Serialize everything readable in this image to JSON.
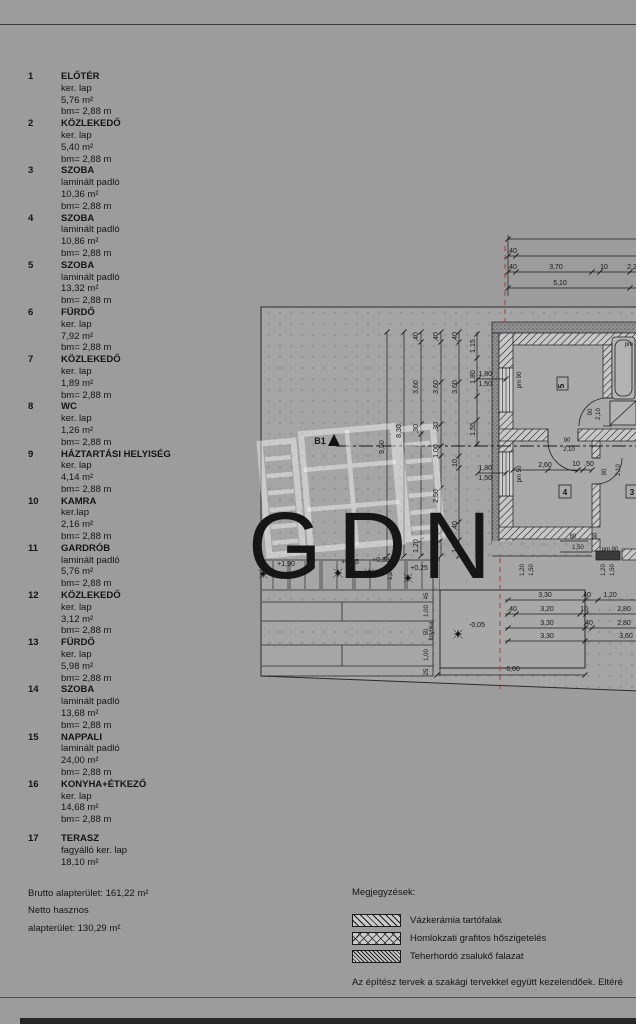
{
  "page": {
    "bottom_note": "Az építész tervek a szakági tervekkel együtt kezelendőek. Eltéré",
    "watermark": "GDN"
  },
  "schedule": {
    "rooms": [
      {
        "num": "1",
        "name": "ELŐTÉR",
        "floor": "ker. lap",
        "area": "5,76 m²",
        "height": "bm= 2,88 m"
      },
      {
        "num": "2",
        "name": "KÖZLEKEDŐ",
        "floor": "ker. lap",
        "area": "5,40 m²",
        "height": "bm= 2,88 m"
      },
      {
        "num": "3",
        "name": "SZOBA",
        "floor": "laminált padló",
        "area": "10,36 m²",
        "height": "bm= 2,88 m"
      },
      {
        "num": "4",
        "name": "SZOBA",
        "floor": "laminált padló",
        "area": "10,86 m²",
        "height": "bm= 2,88 m"
      },
      {
        "num": "5",
        "name": "SZOBA",
        "floor": "laminált padló",
        "area": "13,32 m²",
        "height": "bm= 2,88 m"
      },
      {
        "num": "6",
        "name": "FÜRDŐ",
        "floor": "ker. lap",
        "area": "7,92 m²",
        "height": "bm= 2,88 m"
      },
      {
        "num": "7",
        "name": "KÖZLEKEDŐ",
        "floor": "ker. lap",
        "area": "1,89 m²",
        "height": "bm= 2,88 m"
      },
      {
        "num": "8",
        "name": "WC",
        "floor": "ker. lap",
        "area": "1,26 m²",
        "height": "bm= 2,88 m"
      },
      {
        "num": "9",
        "name": "HÁZTARTÁSI HELYISÉG",
        "floor": "ker. lap",
        "area": "4,14 m²",
        "height": "bm= 2,88 m"
      },
      {
        "num": "10",
        "name": "KAMRA",
        "floor": "ker.lap",
        "area": "2,16 m²",
        "height": "bm= 2,88 m"
      },
      {
        "num": "11",
        "name": "GARDRÓB",
        "floor": "laminált padló",
        "area": "5,76 m²",
        "height": "bm= 2,88 m"
      },
      {
        "num": "12",
        "name": "KÖZLEKEDŐ",
        "floor": "ker. lap",
        "area": "3,12 m²",
        "height": "bm= 2,88 m"
      },
      {
        "num": "13",
        "name": "FÜRDŐ",
        "floor": "ker. lap",
        "area": "5,98 m²",
        "height": "bm= 2,88 m"
      },
      {
        "num": "14",
        "name": "SZOBA",
        "floor": "laminált padló",
        "area": "13,68 m²",
        "height": "bm= 2,88 m"
      },
      {
        "num": "15",
        "name": "NAPPALI",
        "floor": "laminált padló",
        "area": "24,00 m²",
        "height": "bm= 2,88 m"
      },
      {
        "num": "16",
        "name": "KONYHA+ÉTKEZŐ",
        "floor": "ker. lap",
        "area": "14,68 m²",
        "height": "bm= 2,88 m"
      }
    ],
    "room17": {
      "num": "17",
      "name": "TERASZ",
      "floor": "fagyálló ker. lap",
      "area": "18,10 m²",
      "height": ""
    },
    "totals": {
      "line1": "Brutto alapterület: 161,22 m²",
      "line2": "Netto hasznos",
      "line3": "alapterület: 130,29 m²"
    }
  },
  "notes": {
    "title": "Megjegyzések:",
    "legend": [
      {
        "label": "Vázkerámia tartófalak",
        "pattern": "diag"
      },
      {
        "label": "Homlokzati grafitos hőszigetelés",
        "pattern": "crossx"
      },
      {
        "label": "Teherhordó zsalukő falazat",
        "pattern": "dense"
      }
    ]
  },
  "plan": {
    "section_label": "B1",
    "texts": [
      {
        "t": ",40",
        "x": 512,
        "y": 253
      },
      {
        "t": ",40",
        "x": 512,
        "y": 269
      },
      {
        "t": "3,70",
        "x": 556,
        "y": 269
      },
      {
        "t": "10",
        "x": 604,
        "y": 269
      },
      {
        "t": "2,2",
        "x": 632,
        "y": 269
      },
      {
        "t": "5,10",
        "x": 560,
        "y": 285
      },
      {
        "t": "9,50",
        "x": 384,
        "y": 447,
        "r": -90
      },
      {
        "t": "8,30",
        "x": 401,
        "y": 431,
        "r": -90
      },
      {
        "t": ",40",
        "x": 418,
        "y": 337,
        "r": -90
      },
      {
        "t": "3,60",
        "x": 418,
        "y": 387,
        "r": -90
      },
      {
        "t": ",30",
        "x": 418,
        "y": 429,
        "r": -90
      },
      {
        "t": "1,20",
        "x": 418,
        "y": 546,
        "r": -90
      },
      {
        "t": ",40",
        "x": 438,
        "y": 337,
        "r": -90
      },
      {
        "t": "3,60",
        "x": 438,
        "y": 387,
        "r": -90
      },
      {
        "t": ",30",
        "x": 438,
        "y": 427,
        "r": -90
      },
      {
        "t": "1,00",
        "x": 438,
        "y": 451,
        "r": -90
      },
      {
        "t": "2,50",
        "x": 438,
        "y": 496,
        "r": -90
      },
      {
        "t": ",40",
        "x": 438,
        "y": 526,
        "r": -90
      },
      {
        "t": "1,20",
        "x": 438,
        "y": 546,
        "r": -90
      },
      {
        "t": ",40",
        "x": 457,
        "y": 337,
        "r": -90
      },
      {
        "t": "3,60",
        "x": 457,
        "y": 387,
        "r": -90
      },
      {
        "t": "10",
        "x": 457,
        "y": 463,
        "r": -90
      },
      {
        "t": ",40",
        "x": 457,
        "y": 526,
        "r": -90
      },
      {
        "t": "1,20",
        "x": 457,
        "y": 546,
        "r": -90
      },
      {
        "t": "1,15",
        "x": 475,
        "y": 346,
        "r": -90
      },
      {
        "t": "1,80",
        "x": 475,
        "y": 377,
        "r": -90
      },
      {
        "t": "1,55",
        "x": 475,
        "y": 429,
        "r": -90
      },
      {
        "t": "1,80",
        "x": 492,
        "y": 376,
        "a": "e"
      },
      {
        "t": "1,50",
        "x": 492,
        "y": 386,
        "a": "e"
      },
      {
        "t": "1,80",
        "x": 492,
        "y": 470,
        "a": "e"
      },
      {
        "t": "1,50",
        "x": 492,
        "y": 480,
        "a": "e"
      },
      {
        "t": "pm 90",
        "x": 521,
        "y": 380,
        "r": -90,
        "s": 6
      },
      {
        "t": "pm 50",
        "x": 521,
        "y": 474,
        "r": -90,
        "s": 6
      },
      {
        "t": "90",
        "x": 567,
        "y": 442,
        "s": 6
      },
      {
        "t": "2,10",
        "x": 569,
        "y": 451,
        "s": 6
      },
      {
        "t": "90",
        "x": 592,
        "y": 412,
        "r": -90,
        "s": 6
      },
      {
        "t": "2,10",
        "x": 600,
        "y": 414,
        "r": -90,
        "s": 6
      },
      {
        "t": "90",
        "x": 606,
        "y": 472,
        "r": -90,
        "s": 6
      },
      {
        "t": "2,10",
        "x": 620,
        "y": 470,
        "r": -90,
        "s": 6
      },
      {
        "t": "2,60",
        "x": 545,
        "y": 467
      },
      {
        "t": "10",
        "x": 576,
        "y": 466
      },
      {
        "t": ",50",
        "x": 589,
        "y": 466
      },
      {
        "t": "80",
        "x": 573,
        "y": 538,
        "s": 6
      },
      {
        "t": "1,50",
        "x": 578,
        "y": 549,
        "s": 6
      },
      {
        "t": "90",
        "x": 597,
        "y": 536,
        "r": -90,
        "s": 6
      },
      {
        "t": "pm 90",
        "x": 610,
        "y": 551,
        "s": 6
      },
      {
        "t": "1,20",
        "x": 605,
        "y": 570,
        "r": -90,
        "s": 6
      },
      {
        "t": "1,50",
        "x": 614,
        "y": 570,
        "r": -90,
        "s": 6
      },
      {
        "t": "1,20",
        "x": 524,
        "y": 570,
        "r": -90,
        "s": 6
      },
      {
        "t": "1,50",
        "x": 533,
        "y": 570,
        "r": -90,
        "s": 6
      },
      {
        "t": "3,30",
        "x": 545,
        "y": 597
      },
      {
        "t": ",40",
        "x": 586,
        "y": 597
      },
      {
        "t": "1,20",
        "x": 610,
        "y": 597
      },
      {
        "t": ",40",
        "x": 512,
        "y": 611
      },
      {
        "t": "3,20",
        "x": 547,
        "y": 611
      },
      {
        "t": "10",
        "x": 584,
        "y": 611
      },
      {
        "t": "2,80",
        "x": 624,
        "y": 611
      },
      {
        "t": "3,30",
        "x": 547,
        "y": 625
      },
      {
        "t": ",40",
        "x": 588,
        "y": 625
      },
      {
        "t": "2,80",
        "x": 624,
        "y": 625
      },
      {
        "t": "3,30",
        "x": 547,
        "y": 638
      },
      {
        "t": "3,60",
        "x": 626,
        "y": 638
      },
      {
        "t": "6,00",
        "x": 513,
        "y": 671
      },
      {
        "t": "-0,05",
        "x": 477,
        "y": 627
      },
      {
        "t": "folyóka",
        "x": 433,
        "y": 631,
        "r": -90,
        "s": 6
      },
      {
        "t": "+1,90",
        "x": 286,
        "y": 566
      },
      {
        "t": "+0,85",
        "x": 350,
        "y": 564
      },
      {
        "t": "+0,55",
        "x": 381,
        "y": 562
      },
      {
        "t": "1,20",
        "x": 392,
        "y": 574,
        "r": -90,
        "s": 6
      },
      {
        "t": "+0,25",
        "x": 419,
        "y": 570
      },
      {
        "t": "45",
        "x": 428,
        "y": 596,
        "r": -90,
        "s": 6
      },
      {
        "t": "1,00",
        "x": 428,
        "y": 611,
        "r": -90,
        "s": 6
      },
      {
        "t": "50",
        "x": 428,
        "y": 632,
        "r": -90,
        "s": 6
      },
      {
        "t": "1,00",
        "x": 428,
        "y": 655,
        "r": -90,
        "s": 6
      },
      {
        "t": "25",
        "x": 428,
        "y": 672,
        "r": -90,
        "s": 6
      },
      {
        "t": "5",
        "x": 564,
        "y": 386,
        "r": -90,
        "s": 8,
        "b": true
      },
      {
        "t": "4",
        "x": 565,
        "y": 495,
        "s": 8,
        "b": true
      },
      {
        "t": "3",
        "x": 632,
        "y": 495,
        "s": 8,
        "b": true
      },
      {
        "t": "B1",
        "x": 320,
        "y": 444,
        "s": 9,
        "b": true
      },
      {
        "t": "pm",
        "x": 629,
        "y": 346,
        "s": 6
      }
    ],
    "spot_markers": [
      [
        263,
        574
      ],
      [
        338,
        573
      ],
      [
        369,
        573
      ],
      [
        408,
        578
      ],
      [
        458,
        634
      ]
    ]
  }
}
